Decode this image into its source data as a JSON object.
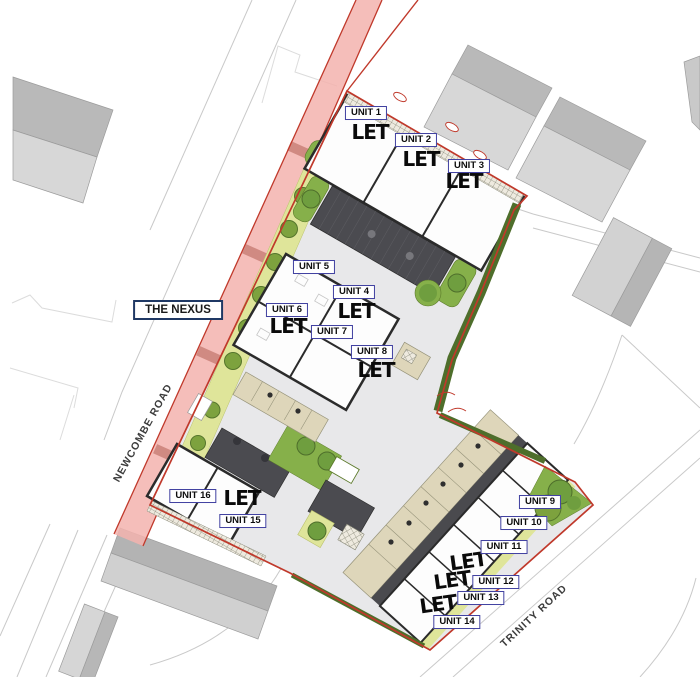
{
  "plan": {
    "name_label": "THE NEXUS",
    "roads": [
      {
        "name": "NEWCOMBE ROAD"
      },
      {
        "name": "TRINITY ROAD"
      }
    ],
    "units": [
      {
        "label": "UNIT 1",
        "status": "LET"
      },
      {
        "label": "UNIT 2",
        "status": "LET"
      },
      {
        "label": "UNIT 3",
        "status": "LET"
      },
      {
        "label": "UNIT 4",
        "status": "LET"
      },
      {
        "label": "UNIT 5",
        "status": ""
      },
      {
        "label": "UNIT 6",
        "status": "LET"
      },
      {
        "label": "UNIT 7",
        "status": ""
      },
      {
        "label": "UNIT 8",
        "status": "LET"
      },
      {
        "label": "UNIT 9",
        "status": ""
      },
      {
        "label": "UNIT 10",
        "status": ""
      },
      {
        "label": "UNIT 11",
        "status": ""
      },
      {
        "label": "UNIT 12",
        "status": "LET"
      },
      {
        "label": "UNIT 13",
        "status": "LET"
      },
      {
        "label": "UNIT 14",
        "status": "LET"
      },
      {
        "label": "UNIT 15",
        "status": "LET"
      },
      {
        "label": "UNIT 16",
        "status": ""
      }
    ],
    "colors": {
      "boundary_red": "#c0392b",
      "road_highlight_pink": "#f3b3ae",
      "landscape_green": "#86b04a",
      "tree_green": "#6f9e3f",
      "hedge_dark_green": "#4e6e2b",
      "verge_lime": "#dfe59a",
      "parking_tan": "#ded6ba",
      "roof_dark_gray": "#4b4b50",
      "context_building_gray": "#c6c6c6",
      "paving_gray": "#e8e8ea",
      "unit_label_border_blue": "#4040a0",
      "site_label_border_navy": "#1f3864"
    }
  }
}
